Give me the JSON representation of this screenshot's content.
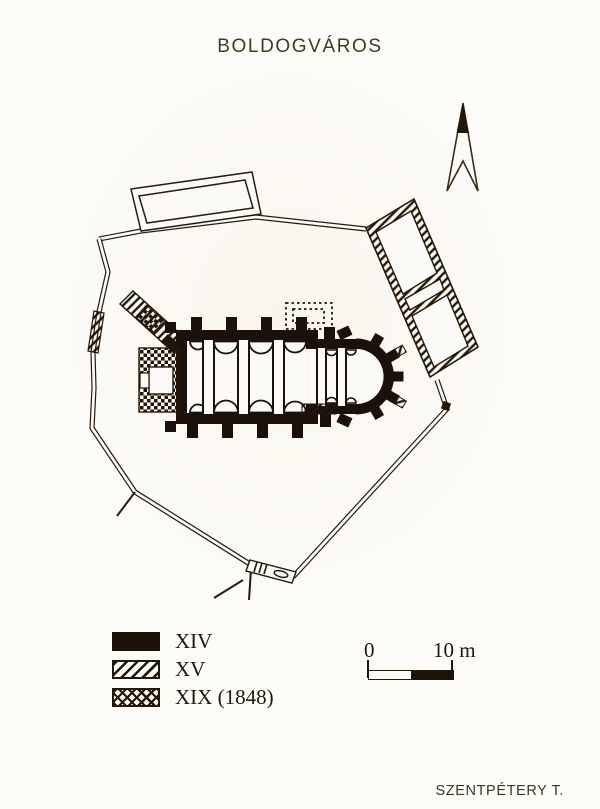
{
  "page": {
    "title": "BOLDOGVÁROS",
    "attribution": "SZENTPÉTERY T."
  },
  "legend": {
    "items": [
      {
        "label": "XIV",
        "pattern": "solid-black",
        "color": "#1d1209"
      },
      {
        "label": "XV",
        "pattern": "diagonal-hatch",
        "color": "#241708"
      },
      {
        "label": "XIX (1848)",
        "pattern": "cross-hatch",
        "color": "#241708"
      }
    ]
  },
  "scale_bar": {
    "start_label": "0",
    "end_label": "10 m"
  },
  "colors": {
    "ink": "#241708",
    "paper": "#fcfaf6",
    "title_text": "#3f3c1e"
  }
}
